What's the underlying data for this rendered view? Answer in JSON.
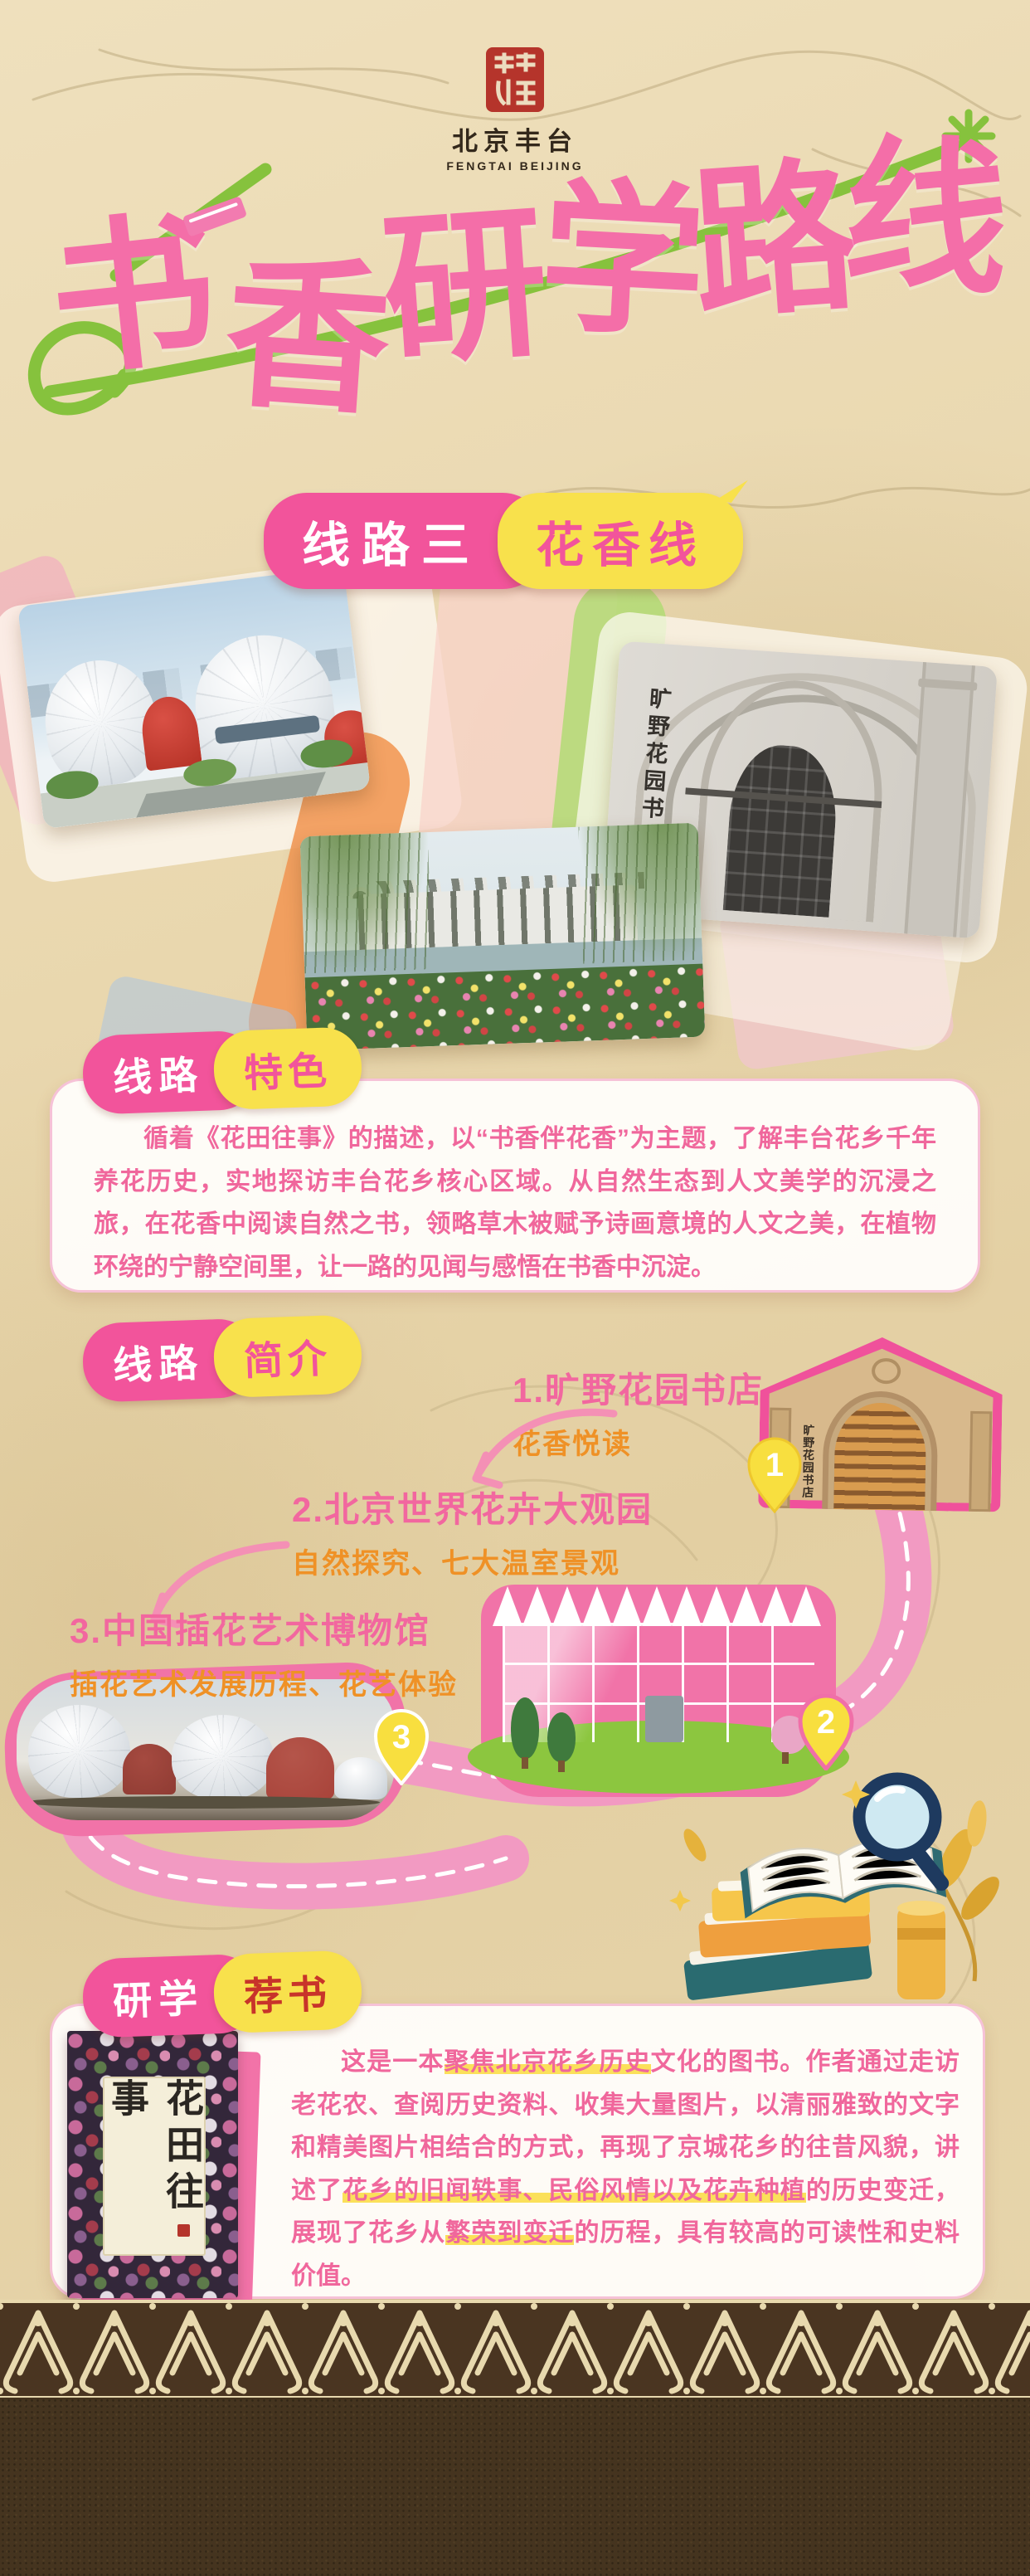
{
  "logo": {
    "name_cn": "北京丰台",
    "name_en": "FENGTAI BEIJING"
  },
  "title": {
    "text": "书香研学路线"
  },
  "route_banner": {
    "left": "线路三",
    "right": "花香线"
  },
  "shared": {
    "bookstore_sign": "旷野花园书店"
  },
  "feature": {
    "badge_left": "线路",
    "badge_right": "特色",
    "paragraph": "循着《花田往事》的描述，以“书香伴花香”为主题，了解丰台花乡千年养花历史，实地探访丰台花乡核心区域。从自然生态到人文美学的沉浸之旅，在花香中阅读自然之书，领略草木被赋予诗画意境的人文之美，在植物环绕的宁静空间里，让一路的见闻与感悟在书香中沉淀。"
  },
  "intro": {
    "badge_left": "线路",
    "badge_right": "简介",
    "stops": [
      {
        "num": "1",
        "title": "1.旷野花园书店",
        "subtitle": "花香悦读"
      },
      {
        "num": "2",
        "title": "2.北京世界花卉大观园",
        "subtitle": "自然探究、七大温室景观"
      },
      {
        "num": "3",
        "title": "3.中国插花艺术博物馆",
        "subtitle": "插花艺术发展历程、花艺体验"
      }
    ]
  },
  "recommend": {
    "badge_left": "研学",
    "badge_right": "荐书",
    "book_title": "花田往事",
    "paragraph_segments": [
      {
        "text": "这是一本",
        "hl": false
      },
      {
        "text": "聚焦北京花乡历史",
        "hl": true
      },
      {
        "text": "文化的图书。作者通过走访老花农、查阅历史资料、收集大量图片，以清丽雅致的文字和精美图片相结合的方式，再现了京城花乡的往昔风貌，讲述了",
        "hl": false
      },
      {
        "text": "花乡的旧闻轶事、民俗风情以及花卉种植",
        "hl": true
      },
      {
        "text": "的历史变迁，展现了花乡从",
        "hl": false
      },
      {
        "text": "繁荣到变迁",
        "hl": true
      },
      {
        "text": "的历程，具有较高的可读性和史料价值。",
        "hl": false
      }
    ]
  },
  "colors": {
    "pink": "#f2549b",
    "title_pink": "#f46ea8",
    "yellow": "#f8e14c",
    "orange_sub": "#ef9126",
    "green": "#86c23d",
    "text_pink": "#f0679c",
    "road_pink": "#f29ac2",
    "paper": "#e9d8b2",
    "footer_brown": "#45341f"
  }
}
